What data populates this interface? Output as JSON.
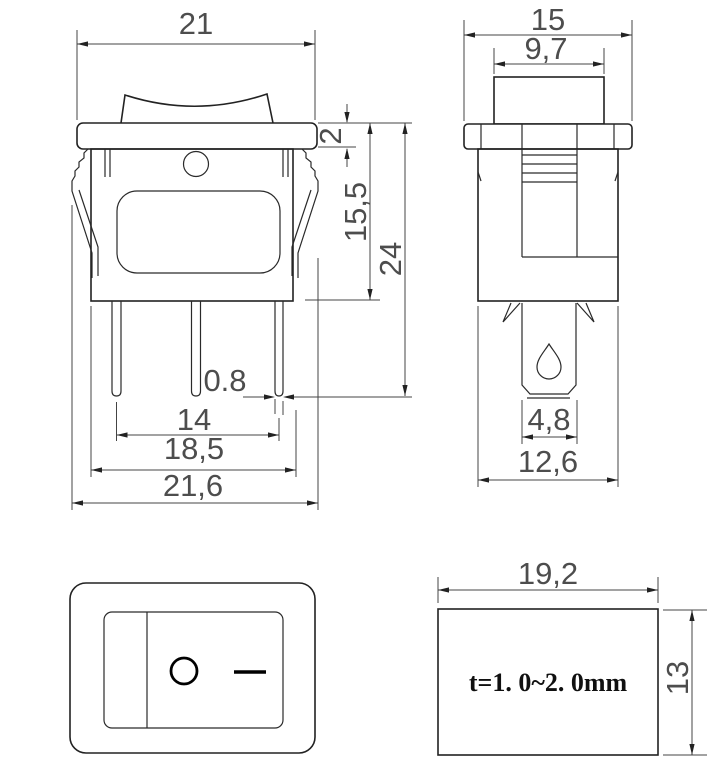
{
  "drawing": {
    "title": "rocker switch dimensional drawing",
    "front_view": {
      "dim_width_top": "21",
      "dim_flange_thickness": "2",
      "dim_body_height": "15,5",
      "dim_total_height": "24",
      "dim_terminal_thickness": "0.8",
      "dim_terminal_pitch": "14",
      "dim_body_width": "18,5",
      "dim_overall_width": "21,6"
    },
    "side_view": {
      "dim_flange_depth": "15",
      "dim_rocker_depth": "9,7",
      "dim_terminal_width": "4,8",
      "dim_body_depth": "12,6"
    },
    "face_view": {
      "off_symbol": "O",
      "on_symbol": "—"
    },
    "panel_cutout": {
      "dim_width": "19,2",
      "dim_height": "13",
      "thickness_note": "t=1. 0~2. 0mm"
    }
  }
}
